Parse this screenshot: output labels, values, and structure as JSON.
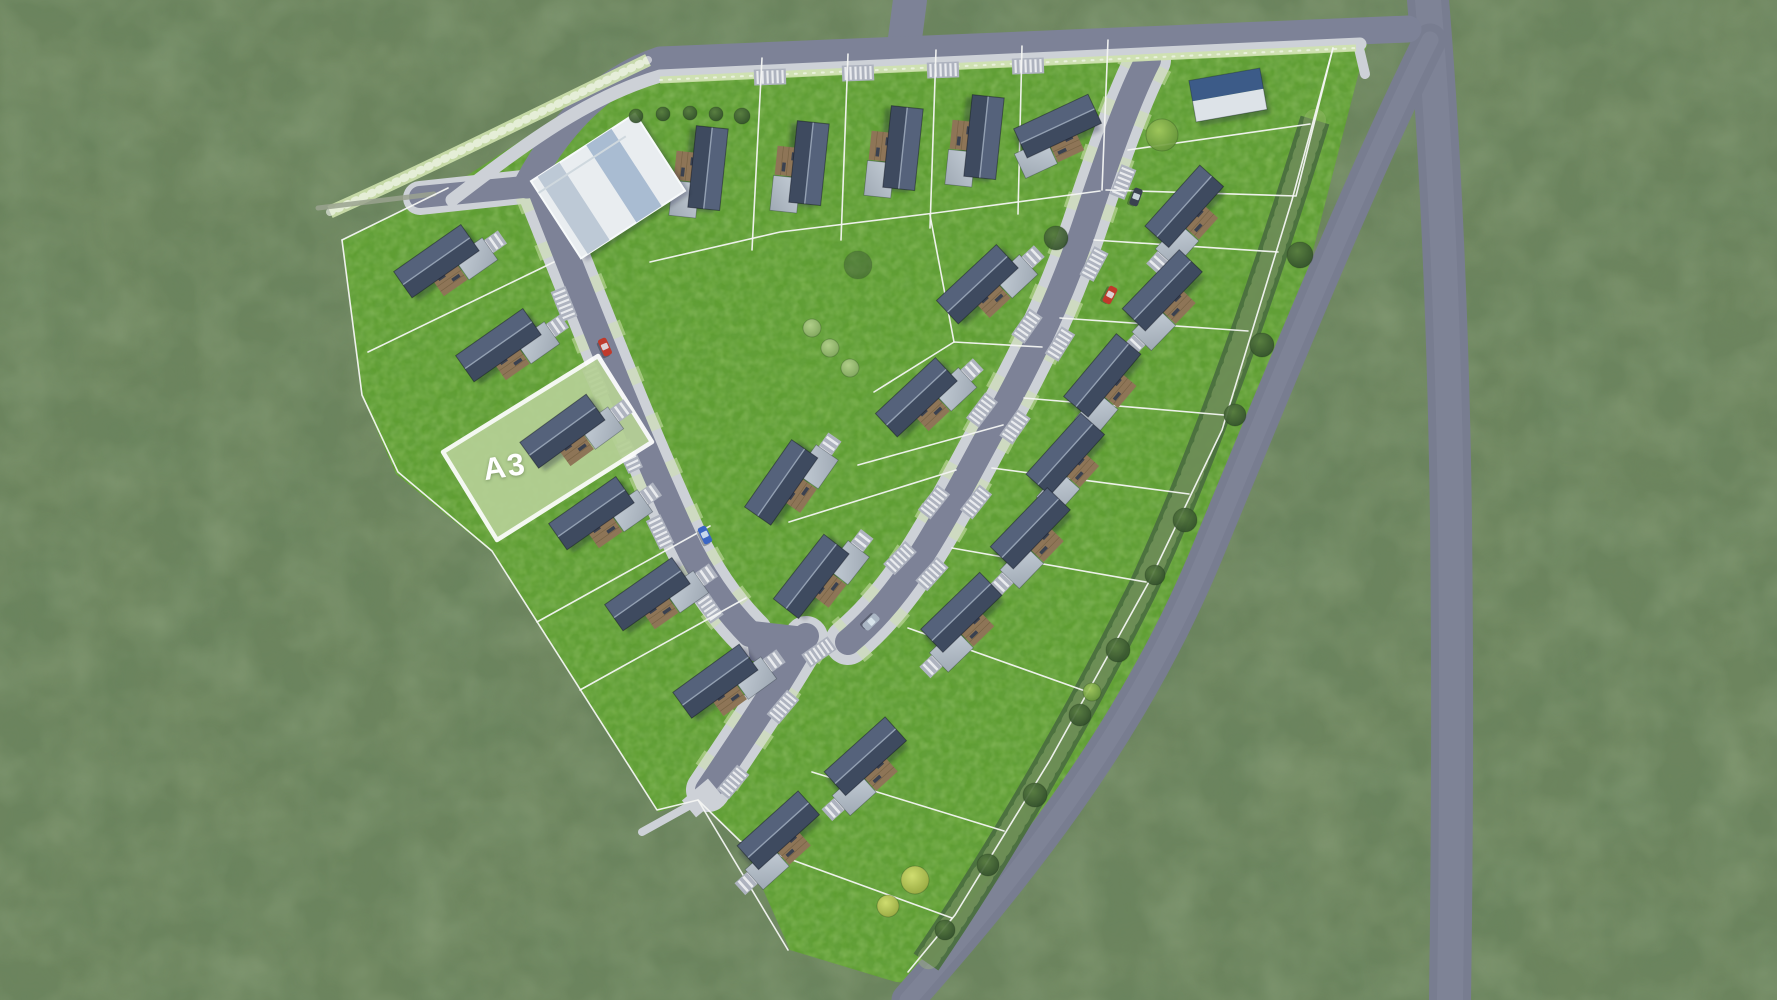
{
  "meta": {
    "canvas_width": 1777,
    "canvas_height": 1000
  },
  "highlight_plot": {
    "label": "A3",
    "points": "443,452 598,356 652,442 497,540",
    "fill": "#b5d095",
    "border_color": "#ffffff",
    "border_width": 4.5
  },
  "colors": {
    "outer_grass": "#6d855e",
    "parcel_grass": "#5f9e33",
    "road": "#7d8297",
    "road_ext": "#787d90",
    "road_wear": "#8d92a4",
    "sidewalk": "#cdd1d7",
    "white_line": "#f4f6f3",
    "roof_top_half": "#55627b",
    "roof_bottom_half": "#3e4a5f",
    "ridge": "#93a0b2",
    "annex_light": "#c6cfd8",
    "annex_dark": "#9fa9b4",
    "terrace": "#8e7557",
    "terrace_dark": "#6f5c3e",
    "stripe_light": "#e9ebee",
    "stripe_base": "#aeb3bf",
    "flower": "#cfe2ae",
    "hedge": "#4b6f3f",
    "hedge_speckle": "#a9c27d",
    "gravel": "#9aa28f",
    "building_white": "#e9edf0",
    "building_band_light": "#bdc9d6",
    "building_band_mid": "#a9bcd2",
    "shed_blue": "#3c5b88",
    "shed_white": "#dde3e8"
  },
  "tree_gradients": {
    "dark": [
      "#587c41",
      "#2e4a29"
    ],
    "light": [
      "#b7d390",
      "#7fa45c"
    ],
    "bright": [
      "#a3c95e",
      "#5f8f36"
    ],
    "yellow": [
      "#d8e274",
      "#97a63e"
    ],
    "soft": [
      "#4e7040",
      "#3a5631"
    ]
  },
  "car_colors": {
    "red": "#c0392b",
    "blue": "#3b66c4",
    "silver": "#aab6c4",
    "dark": "#3a4150"
  },
  "map": {
    "parcel_points": "342,240 448,188 648,58 1372,30 1362,60 1290,340 1203,560 1048,822 938,985 896,982 790,950 742,842 698,800 658,812 492,552 396,474 362,396",
    "ext_roads": [
      {
        "d": "M1428 0 C1438 120 1448 300 1451 520 C1453 700 1452 860 1450 1000",
        "w": 42
      },
      {
        "d": "M1430 40 C1360 180 1282 372 1205 558 C1128 742 1010 884 908 1000",
        "w": 33
      }
    ],
    "casings": [
      {
        "d": "M540 190 C560 240 580 290 602 345 C630 415 655 475 685 540 C700 572 722 606 750 634",
        "w": 46
      },
      {
        "d": "M1148 60 C1130 95 1110 150 1085 225 C1060 300 1030 360 1000 415 C975 460 945 520 915 565 C895 595 872 622 848 642",
        "w": 46
      },
      {
        "d": "M806 638 C782 680 747 732 708 790",
        "w": 44
      },
      {
        "d": "M420 198 L532 186",
        "w": 34
      }
    ],
    "pockets": [
      {
        "d": "M540 190 C560 240 580 290 602 345 C630 415 655 475 685 540 C700 572 722 606 750 634",
        "w": 52
      },
      {
        "d": "M1148 60 C1130 95 1110 150 1085 225 C1060 300 1030 360 1000 415 C975 460 945 520 915 565 C895 595 872 622 848 642",
        "w": 52
      },
      {
        "d": "M806 638 C782 680 747 732 708 790",
        "w": 50
      }
    ],
    "streets": [
      {
        "d": "M910 0 L903 54",
        "w": 34
      },
      {
        "d": "M527 185 C556 130 600 80 660 60 L1408 29",
        "w": 27
      },
      {
        "d": "M540 188 C560 240 580 290 602 345 C630 415 655 475 685 540 C700 572 722 606 750 634",
        "w": 26
      },
      {
        "d": "M1148 60 C1130 95 1110 150 1085 225 C1060 300 1030 360 1000 415 C975 460 945 520 915 565 C895 595 872 622 848 642",
        "w": 26
      },
      {
        "d": "M806 636 C782 680 747 732 708 790",
        "w": 26
      },
      {
        "d": "M420 197 L534 186",
        "w": 22
      }
    ],
    "junction_patch": "744,620 814,628 790,674 750,660",
    "sidewalks": [
      {
        "d": "M452 200 C520 148 585 98 660 76 L1360 44",
        "w": 13
      },
      {
        "d": "M1358 44 L1365 74",
        "w": 10
      },
      {
        "d": "M696 802 L642 832",
        "w": 8
      }
    ],
    "strips": [
      {
        "d": "M330 212 C420 172 520 122 648 60",
        "w": 13,
        "kind": "flower"
      },
      {
        "d": "M660 80 L1356 48",
        "w": 7,
        "kind": "flower"
      },
      {
        "d": "M318 208 L434 194",
        "w": 5,
        "kind": "gravel"
      },
      {
        "d": "M1315 120 C1272 260 1212 440 1142 590 C1062 750 982 880 926 962",
        "w": 30,
        "kind": "hedge"
      }
    ],
    "plot_lines": [
      "M762 58 L752 250",
      "M848 54 L841 240",
      "M936 50 L930 228",
      "M1022 46 L1018 214",
      "M1108 40 L1102 190",
      "M650 262 L780 232 L935 213 L1100 191",
      "M1333 48 L1296 196 L1106 190",
      "M554 262 L368 352",
      "M710 526 L537 622",
      "M746 598 L580 690",
      "M698 800 L788 950",
      "M930 215 L954 342",
      "M1042 347 L954 342 L874 392",
      "M1003 425 L858 465",
      "M956 470 L789 522",
      "M1128 150 L1310 124",
      "M1094 240 L1278 252",
      "M1060 318 L1248 331",
      "M1024 398 L1224 415",
      "M992 468 L1189 494",
      "M952 548 L1146 582",
      "M908 628 L1088 692",
      "M812 772 L1004 831",
      "M740 841 L952 918",
      "M342 240 L362 395 L398 472 L492 551 L657 810 L698 800 L740 841",
      "M1333 48 L1292 200 L1222 430 L1150 580 L1050 760 L955 915 L908 972",
      "M342 240 L448 188"
    ],
    "crossings": [
      [
        770,
        77,
        -2
      ],
      [
        858,
        73,
        -2
      ],
      [
        943,
        70,
        -2
      ],
      [
        1028,
        66,
        -2
      ],
      [
        564,
        304,
        68
      ],
      [
        596,
        382,
        66
      ],
      [
        629,
        456,
        65
      ],
      [
        660,
        532,
        64
      ],
      [
        708,
        606,
        55
      ],
      [
        1027,
        326,
        -55
      ],
      [
        982,
        410,
        -53
      ],
      [
        934,
        502,
        -52
      ],
      [
        900,
        558,
        -46
      ],
      [
        1123,
        182,
        -68
      ],
      [
        1094,
        264,
        -62
      ],
      [
        1060,
        344,
        -58
      ],
      [
        1015,
        427,
        -55
      ],
      [
        976,
        502,
        -52
      ],
      [
        932,
        574,
        -48
      ],
      [
        819,
        652,
        -35
      ],
      [
        783,
        707,
        -50
      ],
      [
        733,
        782,
        -50
      ]
    ],
    "houses": [
      {
        "x": 707,
        "y": 168,
        "r": 96,
        "sx": 1,
        "k": "top"
      },
      {
        "x": 808,
        "y": 163,
        "r": 96,
        "sx": 1,
        "k": "top"
      },
      {
        "x": 902,
        "y": 148,
        "r": 96,
        "sx": 1,
        "k": "top"
      },
      {
        "x": 983,
        "y": 137,
        "r": 96,
        "sx": 1,
        "k": "top"
      },
      {
        "x": 1058,
        "y": 127,
        "r": -25,
        "sx": -1,
        "k": "top"
      },
      {
        "x": 437,
        "y": 262,
        "r": -35,
        "sx": 1,
        "k": "std"
      },
      {
        "x": 499,
        "y": 346,
        "r": -35,
        "sx": 1,
        "k": "std"
      },
      {
        "x": 563,
        "y": 432,
        "r": -36,
        "sx": 1,
        "k": "std"
      },
      {
        "x": 592,
        "y": 514,
        "r": -35,
        "sx": 1,
        "k": "std"
      },
      {
        "x": 648,
        "y": 595,
        "r": -35,
        "sx": 1,
        "k": "std"
      },
      {
        "x": 716,
        "y": 682,
        "r": -36,
        "sx": 1,
        "k": "std"
      },
      {
        "x": 978,
        "y": 285,
        "r": -43,
        "sx": 1,
        "k": "std"
      },
      {
        "x": 917,
        "y": 398,
        "r": -43,
        "sx": 1,
        "k": "std"
      },
      {
        "x": 782,
        "y": 483,
        "r": -55,
        "sx": 1,
        "k": "std"
      },
      {
        "x": 812,
        "y": 577,
        "r": -52,
        "sx": 1,
        "k": "std"
      },
      {
        "x": 1185,
        "y": 207,
        "r": -48,
        "sx": -1,
        "k": "std"
      },
      {
        "x": 1163,
        "y": 291,
        "r": -46,
        "sx": -1,
        "k": "std"
      },
      {
        "x": 1103,
        "y": 376,
        "r": -50,
        "sx": -1,
        "k": "std"
      },
      {
        "x": 1066,
        "y": 455,
        "r": -48,
        "sx": -1,
        "k": "std"
      },
      {
        "x": 1031,
        "y": 529,
        "r": -46,
        "sx": -1,
        "k": "std"
      },
      {
        "x": 962,
        "y": 613,
        "r": -44,
        "sx": -1,
        "k": "std"
      },
      {
        "x": 866,
        "y": 757,
        "r": -42,
        "sx": -1,
        "k": "std"
      },
      {
        "x": 779,
        "y": 831,
        "r": -42,
        "sx": -1,
        "k": "std"
      }
    ],
    "buildings": [
      {
        "type": "community-building",
        "x": 608,
        "y": 186,
        "r": -33,
        "w": 124,
        "h": 92
      },
      {
        "type": "blue-roof-shed",
        "x": 1228,
        "y": 95,
        "r": -10,
        "w": 72,
        "h": 42
      }
    ],
    "trees": [
      [
        636,
        116,
        7,
        "dark"
      ],
      [
        663,
        114,
        7,
        "dark"
      ],
      [
        690,
        113,
        7,
        "dark"
      ],
      [
        716,
        114,
        7,
        "dark"
      ],
      [
        742,
        116,
        8,
        "dark"
      ],
      [
        1162,
        135,
        16,
        "bright"
      ],
      [
        1056,
        238,
        12,
        "dark"
      ],
      [
        858,
        265,
        14,
        "soft"
      ],
      [
        812,
        328,
        9,
        "light"
      ],
      [
        830,
        348,
        9,
        "light"
      ],
      [
        850,
        368,
        9,
        "light"
      ],
      [
        1300,
        255,
        13,
        "dark"
      ],
      [
        1262,
        345,
        12,
        "dark"
      ],
      [
        1235,
        415,
        11,
        "dark"
      ],
      [
        1185,
        520,
        12,
        "dark"
      ],
      [
        1155,
        575,
        10,
        "dark"
      ],
      [
        1118,
        650,
        12,
        "dark"
      ],
      [
        1080,
        715,
        11,
        "dark"
      ],
      [
        1035,
        795,
        12,
        "dark"
      ],
      [
        988,
        865,
        11,
        "dark"
      ],
      [
        945,
        930,
        10,
        "dark"
      ],
      [
        915,
        880,
        14,
        "yellow"
      ],
      [
        888,
        906,
        11,
        "yellow"
      ],
      [
        1092,
        692,
        9,
        "bright"
      ]
    ],
    "cars": [
      [
        605,
        347,
        66,
        "red"
      ],
      [
        1110,
        295,
        118,
        "red"
      ],
      [
        705,
        535,
        64,
        "blue"
      ],
      [
        871,
        622,
        136,
        "silver"
      ],
      [
        1136,
        197,
        110,
        "dark"
      ]
    ],
    "pads": [
      {
        "x": 702,
        "y": 798,
        "w": 34,
        "h": 22,
        "r": -40
      }
    ]
  }
}
